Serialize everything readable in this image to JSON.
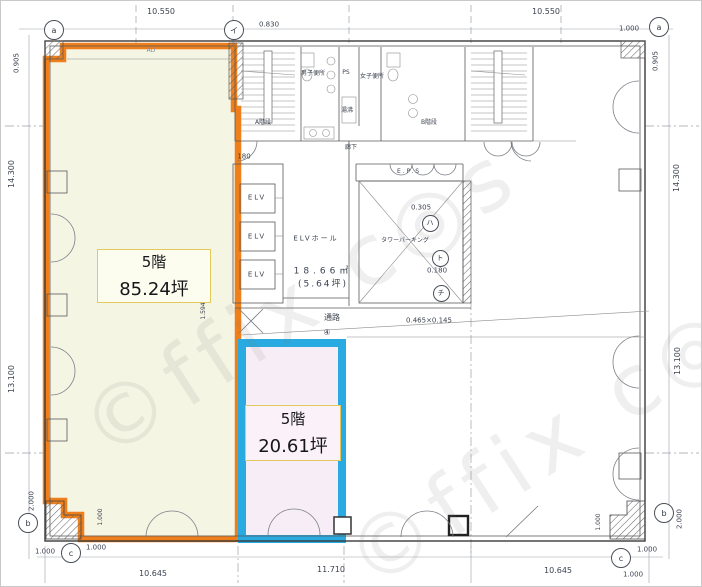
{
  "plan": {
    "watermark": "©ffix c◎s",
    "zone_a": {
      "floor": "5階",
      "area": "85.24坪"
    },
    "zone_b": {
      "floor": "5階",
      "area": "20.61坪"
    },
    "core": {
      "stair_a": "A階段",
      "stair_b": "B階段",
      "mens_toilet": "男子便所",
      "womens_toilet": "女子便所",
      "ps": "PS",
      "water": "湯沸",
      "corridor": "廊下",
      "eps": "E.P.S",
      "elv": "ELV",
      "elv_hall": "ELVホール",
      "elv_area_m2": "18.66㎡",
      "elv_area_tsubo": "(5.64坪)",
      "tower_parking": "タワーパーキング",
      "passage": "通路",
      "passage_no": "④",
      "ad": "AD"
    },
    "markers": {
      "a": "a",
      "i": "イ",
      "b": "b",
      "c": "c",
      "ha": "ハ",
      "to": "ト",
      "chi": "チ"
    },
    "dims": {
      "top_left": "10.550",
      "top_center": "0.830",
      "top_right": "10.550",
      "left_top": "0.905",
      "left_upper": "14.300",
      "left_lower": "13.100",
      "left_bottom": "2.000",
      "right_top": "0.905",
      "right_upper": "14.300",
      "right_lower": "13.100",
      "right_bottom": "2.000",
      "bottom_left": "10.645",
      "bottom_center": "11.710",
      "bottom_right": "10.645",
      "corner_1000": "1.000",
      "d180": "180",
      "d1594": "1.594",
      "d0305": "0.305",
      "d0180": "0.180",
      "passage_dim": "0.465×0.145"
    },
    "colors": {
      "zone_a_border": "#EF7F1A",
      "zone_a_fill": "#F5F5E4",
      "zone_b_border": "#29ABE2",
      "zone_b_fill": "#F7EDF6",
      "label_border": "#E3C95B"
    }
  }
}
